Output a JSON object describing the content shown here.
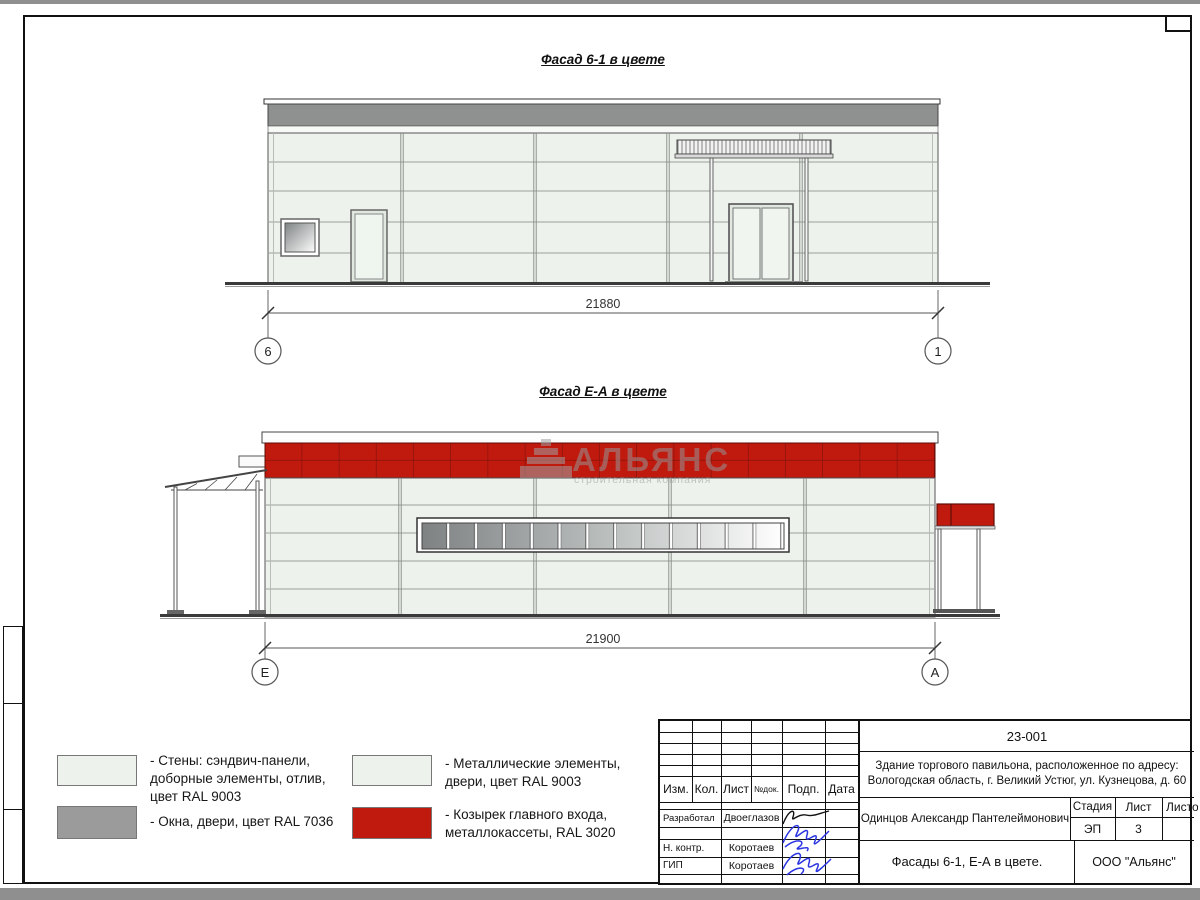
{
  "colors": {
    "wall": "#edf3ec",
    "metal_gray": "#8f9190",
    "cassette_red": "#c0190e",
    "signature_blue": "#2b35e0",
    "ground_line": "#3a3a3a"
  },
  "facade1": {
    "title": "Фасад 6-1 в цвете",
    "dimension": "21880",
    "axis_left": "6",
    "axis_right": "1"
  },
  "facade2": {
    "title": "Фасад Е-А в цвете",
    "dimension": "21900",
    "axis_left": "Е",
    "axis_right": "А"
  },
  "watermark": {
    "name": "АЛЬЯНС",
    "tagline": "строительная компания"
  },
  "legend": {
    "items": [
      {
        "label": "- Стены: сэндвич-панели,\nдоборные элементы, отлив,\nцвет RAL 9003"
      },
      {
        "label": "- Окна, двери, цвет RAL 7036"
      },
      {
        "label": "- Металлические элементы,\nдвери, цвет RAL 9003"
      },
      {
        "label": "- Козырек главного входа,\nметаллокассеты, RAL 3020"
      }
    ]
  },
  "titleblock": {
    "doc_number": "23-001",
    "description": "Здание торгового павильона, расположенное по адресу:\nВологодская область, г. Великий Устюг, ул. Кузнецова, д. 60",
    "columns": {
      "izm": "Изм.",
      "kol": "Кол.",
      "list": "Лист",
      "ndok": "№док.",
      "podp": "Подп.",
      "data": "Дата"
    },
    "roles": [
      {
        "role": "Разработал",
        "name": "Двоеглазов"
      },
      {
        "role": "Н. контр.",
        "name": "Коротаев"
      },
      {
        "role": "ГИП",
        "name": "Коротаев"
      }
    ],
    "approver": "Одинцов Александр Пантелеймонович",
    "stage_label": "Стадия",
    "sheet_label": "Лист",
    "sheets_label": "Листов",
    "stage": "ЭП",
    "sheet_number": "3",
    "sheet_title": "Фасады 6-1, Е-А в цвете.",
    "company": "ООО \"Альянс\""
  }
}
